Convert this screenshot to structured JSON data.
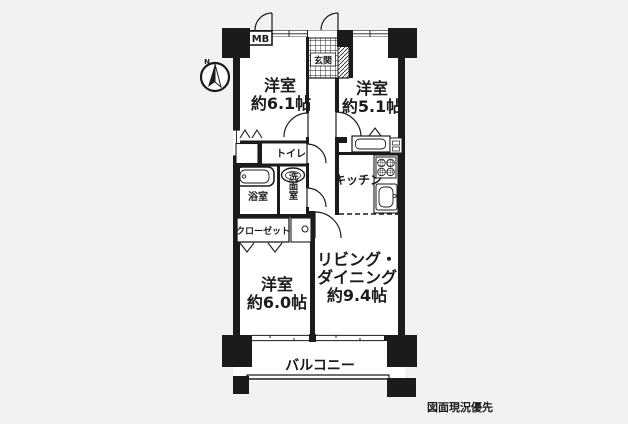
{
  "colors": {
    "line": "#1b1b1b",
    "background": "#f2f2f1",
    "floor": "#ffffff"
  },
  "compass": {
    "label": "N"
  },
  "labels": {
    "mb": "MB",
    "genkan": "玄関",
    "toilet": "トイレ",
    "bath": "浴室",
    "washroom": "洗面室",
    "kitchen": "キッチン",
    "closet": "クローゼット",
    "balcony": "バルコニー"
  },
  "rooms": {
    "bedroom1": {
      "name": "洋室",
      "size": "約6.1帖"
    },
    "bedroom2": {
      "name": "洋室",
      "size": "約5.1帖"
    },
    "bedroom3": {
      "name": "洋室",
      "size": "約6.0帖"
    },
    "living": {
      "line1": "リビング・",
      "line2": "ダイニング",
      "size": "約9.4帖"
    }
  },
  "note": {
    "text": "図面現況優先"
  }
}
